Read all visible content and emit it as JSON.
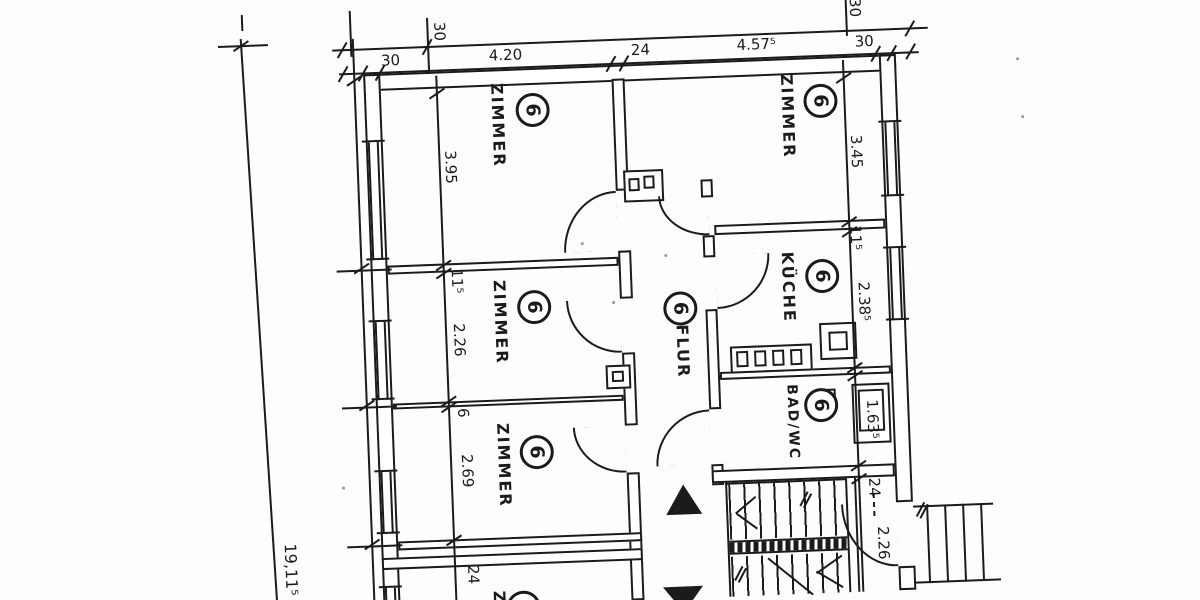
{
  "rooms": {
    "zimmer_top_left": {
      "label": "ZIMMER",
      "number": "6"
    },
    "zimmer_top_right": {
      "label": "ZIMMER",
      "number": "6"
    },
    "zimmer_mid_left": {
      "label": "ZIMMER",
      "number": "6"
    },
    "zimmer_low_left": {
      "label": "ZIMMER",
      "number": "6"
    },
    "zimmer_bottom": {
      "label": "Z",
      "number": ""
    },
    "flur": {
      "label": "FLUR",
      "number": "6"
    },
    "kueche": {
      "label": "KÜCHE",
      "number": "6"
    },
    "bad_wc": {
      "label": "BAD/WC",
      "number": "6"
    }
  },
  "dimensions": {
    "top_chain": {
      "wall_left": "30",
      "room_left_width": "4.20",
      "mid_wall": "24",
      "room_right_width": "4.57⁵",
      "wall_right": "30",
      "wall_depth_left": "30",
      "wall_depth_right": "30"
    },
    "left_chain": {
      "room1_depth": "3.95",
      "wall1": "11⁵",
      "room2_depth": "2.26",
      "wall2": "6",
      "room3_depth": "2.69",
      "wall3": "24"
    },
    "right_chain": {
      "room1_depth": "3.45",
      "wall1": "11⁵",
      "kitchen_depth": "2.38⁵",
      "bath_depth": "1.63⁵",
      "wall2": "24",
      "hall_depth": "2.26"
    },
    "overall_length": "19,11⁵"
  },
  "colors": {
    "ink": "#1b1b1b",
    "paper": "#fdfdfc"
  }
}
